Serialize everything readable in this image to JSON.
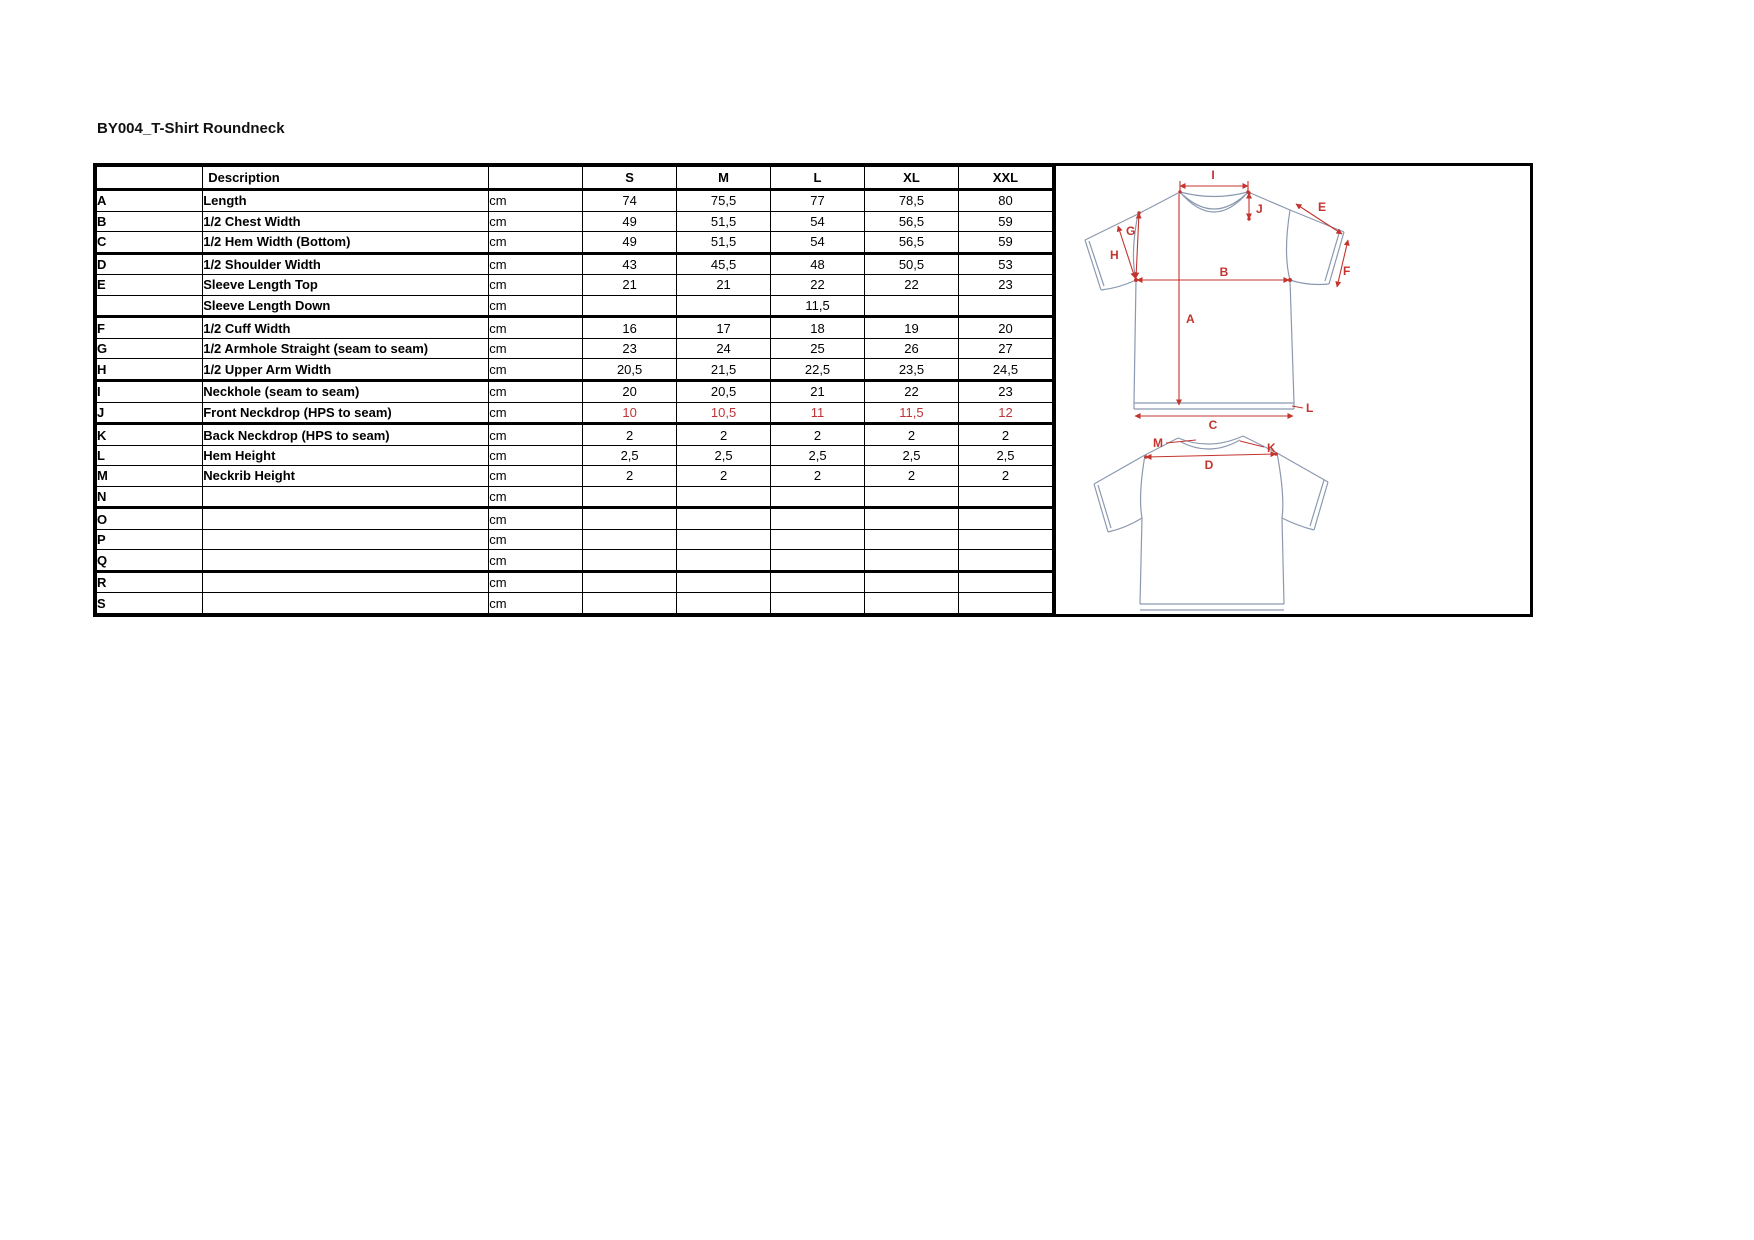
{
  "page": {
    "title": "BY004_T-Shirt Roundneck"
  },
  "table": {
    "headers": [
      "",
      "Description",
      "",
      "S",
      "M",
      "L",
      "XL",
      "XXL"
    ],
    "rows": [
      {
        "letter": "A",
        "description": "Length",
        "unit": "cm",
        "values": [
          "74",
          "75,5",
          "77",
          "78,5",
          "80"
        ]
      },
      {
        "letter": "B",
        "description": "1/2 Chest Width",
        "unit": "cm",
        "values": [
          "49",
          "51,5",
          "54",
          "56,5",
          "59"
        ]
      },
      {
        "letter": "C",
        "description": "1/2 Hem Width (Bottom)",
        "unit": "cm",
        "values": [
          "49",
          "51,5",
          "54",
          "56,5",
          "59"
        ],
        "thick_bottom": true
      },
      {
        "letter": "D",
        "description": "1/2 Shoulder Width",
        "unit": "cm",
        "values": [
          "43",
          "45,5",
          "48",
          "50,5",
          "53"
        ]
      },
      {
        "letter": "E",
        "description": "Sleeve Length Top",
        "unit": "cm",
        "values": [
          "21",
          "21",
          "22",
          "22",
          "23"
        ]
      },
      {
        "letter": "",
        "description": "Sleeve Length Down",
        "unit": "cm",
        "values": [
          "",
          "",
          "11,5",
          "",
          ""
        ],
        "thick_bottom": true
      },
      {
        "letter": "F",
        "description": "1/2 Cuff Width",
        "unit": "cm",
        "values": [
          "16",
          "17",
          "18",
          "19",
          "20"
        ]
      },
      {
        "letter": "G",
        "description": "1/2 Armhole Straight (seam to seam)",
        "unit": "cm",
        "values": [
          "23",
          "24",
          "25",
          "26",
          "27"
        ]
      },
      {
        "letter": "H",
        "description": "1/2 Upper Arm Width",
        "unit": "cm",
        "values": [
          "20,5",
          "21,5",
          "22,5",
          "23,5",
          "24,5"
        ],
        "thick_bottom": true,
        "large_values": true
      },
      {
        "letter": "I",
        "description": "Neckhole (seam to seam)",
        "unit": "cm",
        "values": [
          "20",
          "20,5",
          "21",
          "22",
          "23"
        ]
      },
      {
        "letter": "J",
        "description": "Front Neckdrop (HPS to seam)",
        "unit": "cm",
        "values": [
          "10",
          "10,5",
          "11",
          "11,5",
          "12"
        ],
        "red_values": true,
        "thick_bottom": true
      },
      {
        "letter": "K",
        "description": "Back Neckdrop (HPS to seam)",
        "unit": "cm",
        "values": [
          "2",
          "2",
          "2",
          "2",
          "2"
        ]
      },
      {
        "letter": "L",
        "description": "Hem Height",
        "unit": "cm",
        "values": [
          "2,5",
          "2,5",
          "2,5",
          "2,5",
          "2,5"
        ],
        "large_values": true
      },
      {
        "letter": "M",
        "description": "Neckrib Height",
        "unit": "cm",
        "values": [
          "2",
          "2",
          "2",
          "2",
          "2"
        ]
      },
      {
        "letter": "N",
        "description": "",
        "unit": "cm",
        "values": [
          "",
          "",
          "",
          "",
          ""
        ],
        "thick_bottom": true
      },
      {
        "letter": "O",
        "description": "",
        "unit": "cm",
        "values": [
          "",
          "",
          "",
          "",
          ""
        ]
      },
      {
        "letter": "P",
        "description": "",
        "unit": "cm",
        "values": [
          "",
          "",
          "",
          "",
          ""
        ]
      },
      {
        "letter": "Q",
        "description": "",
        "unit": "cm",
        "values": [
          "",
          "",
          "",
          "",
          ""
        ],
        "thick_bottom": true
      },
      {
        "letter": "R",
        "description": "",
        "unit": "cm",
        "values": [
          "",
          "",
          "",
          "",
          ""
        ]
      },
      {
        "letter": "S",
        "description": "",
        "unit": "cm",
        "values": [
          "",
          "",
          "",
          "",
          ""
        ]
      }
    ]
  },
  "diagram": {
    "labels": {
      "A": "A",
      "B": "B",
      "C": "C",
      "D": "D",
      "E": "E",
      "F": "F",
      "G": "G",
      "H": "H",
      "I": "I",
      "J": "J",
      "K": "K",
      "L": "L",
      "M": "M"
    }
  },
  "colors": {
    "value_red": "#bf3238",
    "annotation_red": "#c4342e",
    "garment_outline": "#8b99b0"
  }
}
